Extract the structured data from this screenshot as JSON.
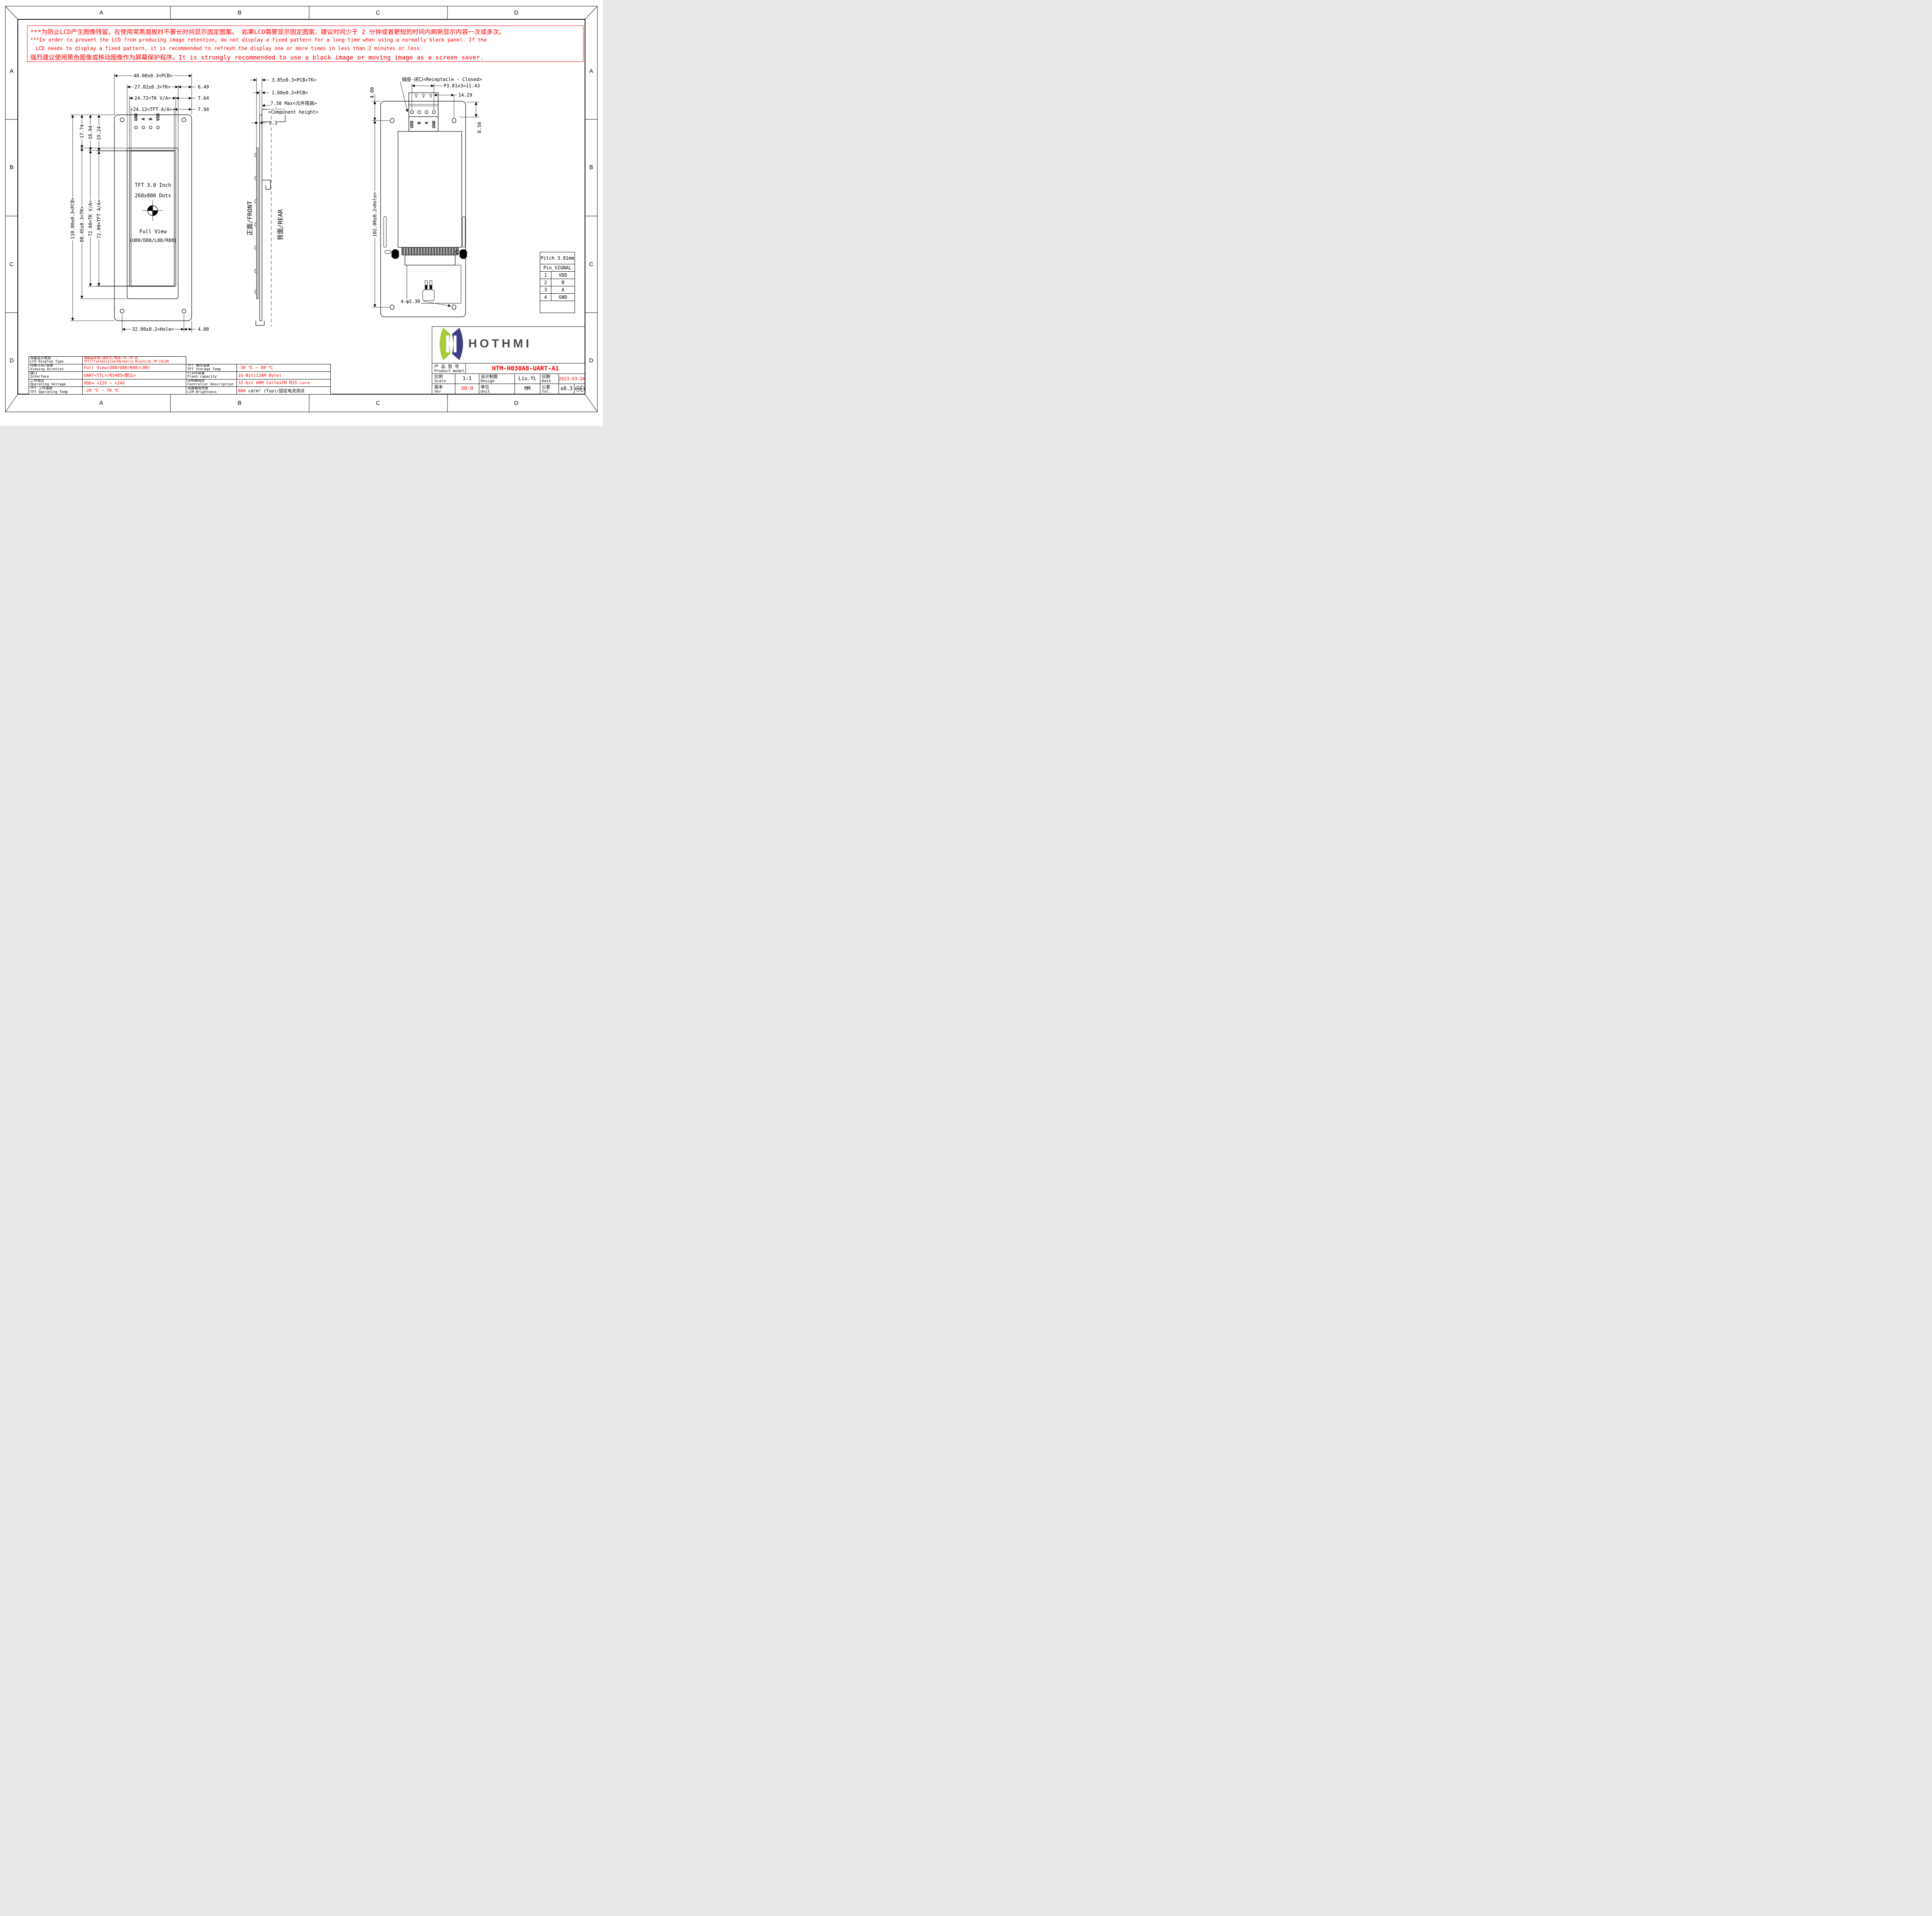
{
  "border": {
    "zones": [
      "A",
      "B",
      "C",
      "D"
    ]
  },
  "warning": {
    "l1": "***为防止LCD产生图像残留，在使用常黑面板时不要长时间显示固定图案。 如果LCD需要显示固定图案，建议时间少于 2 分钟或者更短的时间内刷新显示内容一次或多次。",
    "l2": "***In order to prevent the LCD from producing image retention, do not display a fixed pattern for a long time when using a normally black panel. If the",
    "l3": "LCD needs to display a fixed pattern, it is recommended to refresh the display one or more times in less than 2 minutes or less.",
    "l4": "强烈建议使用黑色图像或移动图像作为屏幕保护程序。It is strongly recommended to use a black image or moving image as a screen saver."
  },
  "front": {
    "label": "正面/FRONT",
    "dim_pcb_w": "40.00±0.3<PCB>",
    "dim_tk_w": "27.02±0.3<TK>",
    "dim_tkva_w": "24.72<TK V/A>",
    "dim_tftaa_w": "24.12<TFT A/A>",
    "dim_649": "6.49",
    "dim_764": "7.64",
    "dim_794": "7.94",
    "dim_pcb_h": "110.00±0.3<PCB>",
    "dim_tk_h": "80.45±0.3<TK>",
    "dim_tkva_h": "72.60<TK V/A>",
    "dim_tftaa_h": "72.00<TFT A/A>",
    "dim_1774": "17.74",
    "dim_1894": "18.94",
    "dim_1924": "19.24",
    "dim_hole": "32.00±0.2<Hole>",
    "dim_400": "4.00",
    "pins": [
      "GND",
      "A",
      "B",
      "VDD"
    ],
    "disp": [
      "TFT 3.0 Inch",
      "268x800 Dots",
      "Full View",
      "(U80/D80/L80/R80)"
    ]
  },
  "side": {
    "label": "背面/REAR",
    "d1": "3.85±0.3<PCB+TK>",
    "d2": "1.60±0.2<PCB>",
    "d3": "7.50 Max<元件限高>",
    "d4": "<Component height>",
    "d5": "0.3"
  },
  "rear": {
    "receptacle": "插座-闭口<Receptacle - Closed>",
    "pitch": "P3.81x3=11.43",
    "d1429": "14.29",
    "d400": "4.00",
    "d850": "8.50",
    "dhole": "102.00±0.2<Hole>",
    "holes": "4-φ2.30",
    "pins": [
      "VDD",
      "B",
      "A",
      "GND"
    ]
  },
  "pin_table": {
    "h1": "Pitch 3.81mm",
    "h2": "Pin_SIGNAL",
    "rows": [
      [
        "1",
        "VDD"
      ],
      [
        "2",
        "B"
      ],
      [
        "3",
        "A"
      ],
      [
        "4",
        "GND"
      ]
    ]
  },
  "logo": {
    "text": "HOTHMI",
    "green": "#a5cd39",
    "navy": "#3c4083",
    "gray": "#4b4b4b"
  },
  "title_block": {
    "product_zh": "产 品 型 号",
    "product_en": "Product model",
    "product_model": "HTM-H030A8-UART-A1",
    "scale_zh": "比例",
    "scale_en": "Scale",
    "scale_val": "1:1",
    "design_zh": "设计制图",
    "design_en": "Design",
    "design_val": "Liu.YL",
    "date_zh": "日期",
    "date_en": "Date",
    "date_val": "2023-03-26",
    "ver_zh": "版本",
    "ver_en": "Ver",
    "ver_val": "V0-0",
    "unit_zh": "单位",
    "unit_en": "Unit",
    "unit_val": "MM",
    "tol_zh": "公差",
    "tol_en": "Tol.",
    "tol_val": "±0.3"
  },
  "spec_left": {
    "rows": [
      {
        "zh": "液晶显示类型",
        "en": "LCD Display Type",
        "line1": "薄膜晶体管/透射式/常黑/16.7M 色",
        "line2": "TFT/Transmissive/Normally Black/16.7M COLOR"
      },
      {
        "zh": "观看方向/角度",
        "en": "Viewing Diretion",
        "value": "Full View(U80/D80/R80/L80)"
      },
      {
        "zh": "接口",
        "en": "Interface",
        "value": "UART<TTL>/RS485<默认>"
      },
      {
        "zh": "工作电压",
        "en": "Operating Voltage",
        "value": "VDD= +12V ~ +24V"
      },
      {
        "zh": "TFT 工作温度",
        "en": "TFT Operating Temp",
        "value": "-20 ℃ ~ 70 ℃"
      }
    ]
  },
  "spec_right": {
    "rows": [
      {
        "zh": "TFT 储存温度",
        "en": "TFT Storage Temp",
        "value": "-30 ℃ ~ 80 ℃"
      },
      {
        "zh": "Flash容量",
        "en": "Flash capacity",
        "value": "1G-Bit(128M Byte)"
      },
      {
        "zh": "控制器描述",
        "en": "Controller Description",
        "value": "32-bit ARM CortexTM M33 core"
      },
      {
        "zh": "液晶模组亮度",
        "en": "LCM Brightness",
        "value_red": "800",
        "value_black": " cd/m² (Typ)/固定电流测试"
      }
    ]
  }
}
